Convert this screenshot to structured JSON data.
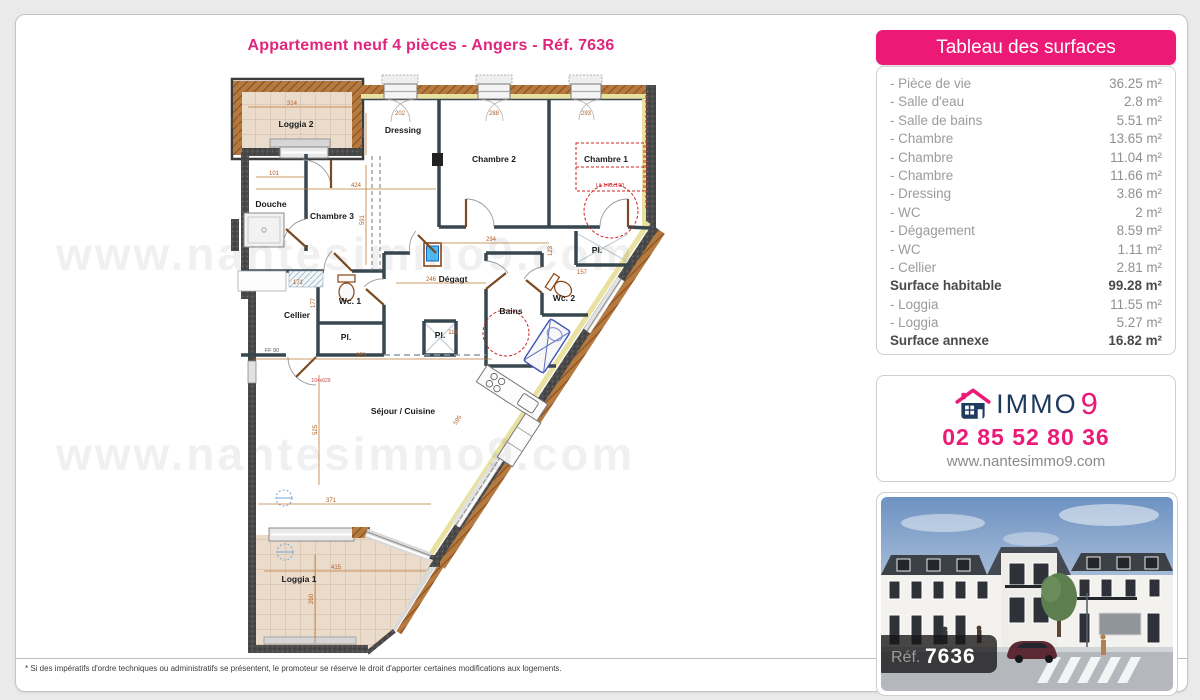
{
  "page": {
    "title": "Appartement neuf 4 pièces - Angers - Réf. 7636",
    "footnote": "* Si des impératifs d'ordre techniques ou administratifs se présentent, le promoteur se réserve le droit d'apporter certaines modifications aux logements.",
    "watermark": "www.nantesimmo9.com"
  },
  "colors": {
    "accent_pink": "#ec1a76",
    "brand_navy": "#1d3a5f"
  },
  "surfaces": {
    "header": "Tableau des surfaces",
    "rows": [
      {
        "label": "- Pièce de vie",
        "value": "36.25 m²"
      },
      {
        "label": "- Salle d'eau",
        "value": "2.8 m²"
      },
      {
        "label": "- Salle de bains",
        "value": "5.51 m²"
      },
      {
        "label": "- Chambre",
        "value": "13.65 m²"
      },
      {
        "label": "- Chambre",
        "value": "11.04 m²"
      },
      {
        "label": "- Chambre",
        "value": "11.66 m²"
      },
      {
        "label": "- Dressing",
        "value": "3.86 m²"
      },
      {
        "label": "- WC",
        "value": "2 m²"
      },
      {
        "label": "- Dégagement",
        "value": "8.59 m²"
      },
      {
        "label": "- WC",
        "value": "1.11 m²"
      },
      {
        "label": "- Cellier",
        "value": "2.81 m²"
      },
      {
        "label": "Surface habitable",
        "value": "99.28 m²"
      },
      {
        "label": "- Loggia",
        "value": "11.55 m²"
      },
      {
        "label": "- Loggia",
        "value": "5.27 m²"
      },
      {
        "label": "Surface annexe",
        "value": "16.82 m²"
      }
    ]
  },
  "contact": {
    "brand_text": "IMMO",
    "brand_digit": "9",
    "phone": "02 85 52 80 36",
    "website": "www.nantesimmo9.com"
  },
  "photo": {
    "ref_label": "Réf.",
    "ref_number": "7636"
  },
  "plan": {
    "rooms": [
      {
        "label": "Loggia 2"
      },
      {
        "label": "Dressing"
      },
      {
        "label": "Chambre 2"
      },
      {
        "label": "Chambre 1"
      },
      {
        "label": "Douche"
      },
      {
        "label": "Chambre 3"
      },
      {
        "label": "Wc. 1"
      },
      {
        "label": "Cellier"
      },
      {
        "label": "Pl."
      },
      {
        "label": "Dégagt"
      },
      {
        "label": "Pl."
      },
      {
        "label": "Bains"
      },
      {
        "label": "Wc. 2"
      },
      {
        "label": "Pl."
      },
      {
        "label": "Séjour / Cuisine"
      },
      {
        "label": "Loggia 1"
      }
    ],
    "dims": [
      "314",
      "101",
      "424",
      "953",
      "371",
      "415",
      "260",
      "525",
      "177",
      "246",
      "294",
      "123",
      "169",
      "591",
      "202",
      "288",
      "293",
      "119",
      "157",
      "104x629",
      "162",
      "171",
      "595"
    ],
    "annotations": {
      "entrance_door": "FF 90",
      "bed": "Lit 140x190"
    }
  }
}
